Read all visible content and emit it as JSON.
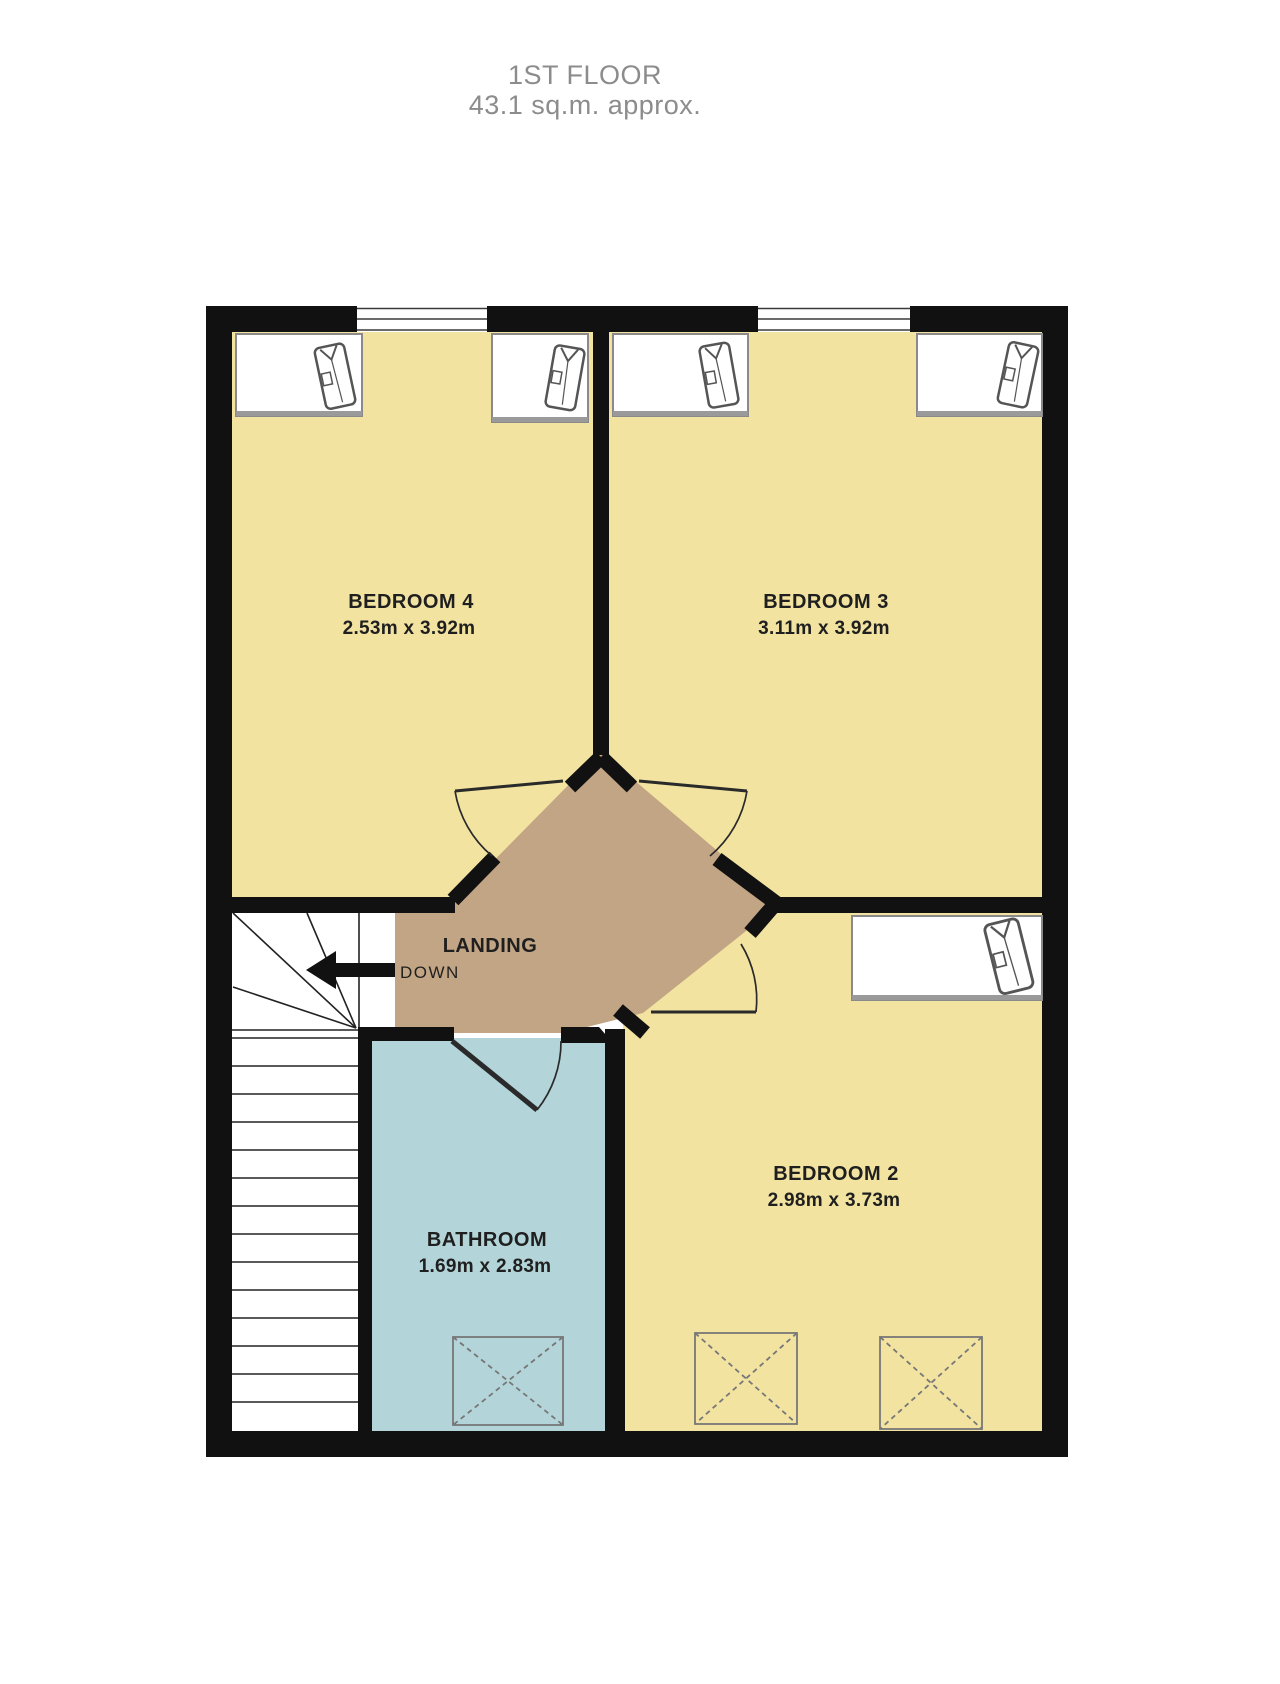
{
  "title": {
    "floor": "1ST FLOOR",
    "area": "43.1 sq.m. approx."
  },
  "rooms": {
    "bedroom4": {
      "name": "BEDROOM 4",
      "dims": "2.53m  x 3.92m"
    },
    "bedroom3": {
      "name": "BEDROOM 3",
      "dims": "3.11m  x 3.92m"
    },
    "bedroom2": {
      "name": "BEDROOM 2",
      "dims": "2.98m  x 3.73m"
    },
    "bathroom": {
      "name": "BATHROOM",
      "dims": "1.69m  x 2.83m"
    },
    "landing": {
      "name": "LANDING"
    }
  },
  "stairs": {
    "direction_label": "DOWN"
  },
  "colors": {
    "bedroom_fill": "#F2E3A1",
    "landing_fill": "#C2A584",
    "bathroom_fill": "#B3D5D9",
    "stairs_fill": "#FFFFFF",
    "wall": "#111111",
    "title_text": "#8C8C8C",
    "label_text": "#1F1F1F"
  },
  "furniture": {
    "wardrobes": [
      {
        "room": "BEDROOM 4",
        "position": "top-left"
      },
      {
        "room": "BEDROOM 4",
        "position": "top-right"
      },
      {
        "room": "BEDROOM 3",
        "position": "top-left"
      },
      {
        "room": "BEDROOM 3",
        "position": "top-right"
      },
      {
        "room": "BEDROOM 2",
        "position": "top-right"
      }
    ],
    "fixtures": [
      {
        "room": "BATHROOM",
        "type": "dashed-cross-box"
      },
      {
        "room": "BEDROOM 2",
        "type": "dashed-cross-box"
      },
      {
        "room": "BEDROOM 2",
        "type": "dashed-cross-box"
      }
    ],
    "windows": [
      {
        "room": "BEDROOM 4",
        "wall": "top"
      },
      {
        "room": "BEDROOM 3",
        "wall": "top"
      }
    ]
  }
}
